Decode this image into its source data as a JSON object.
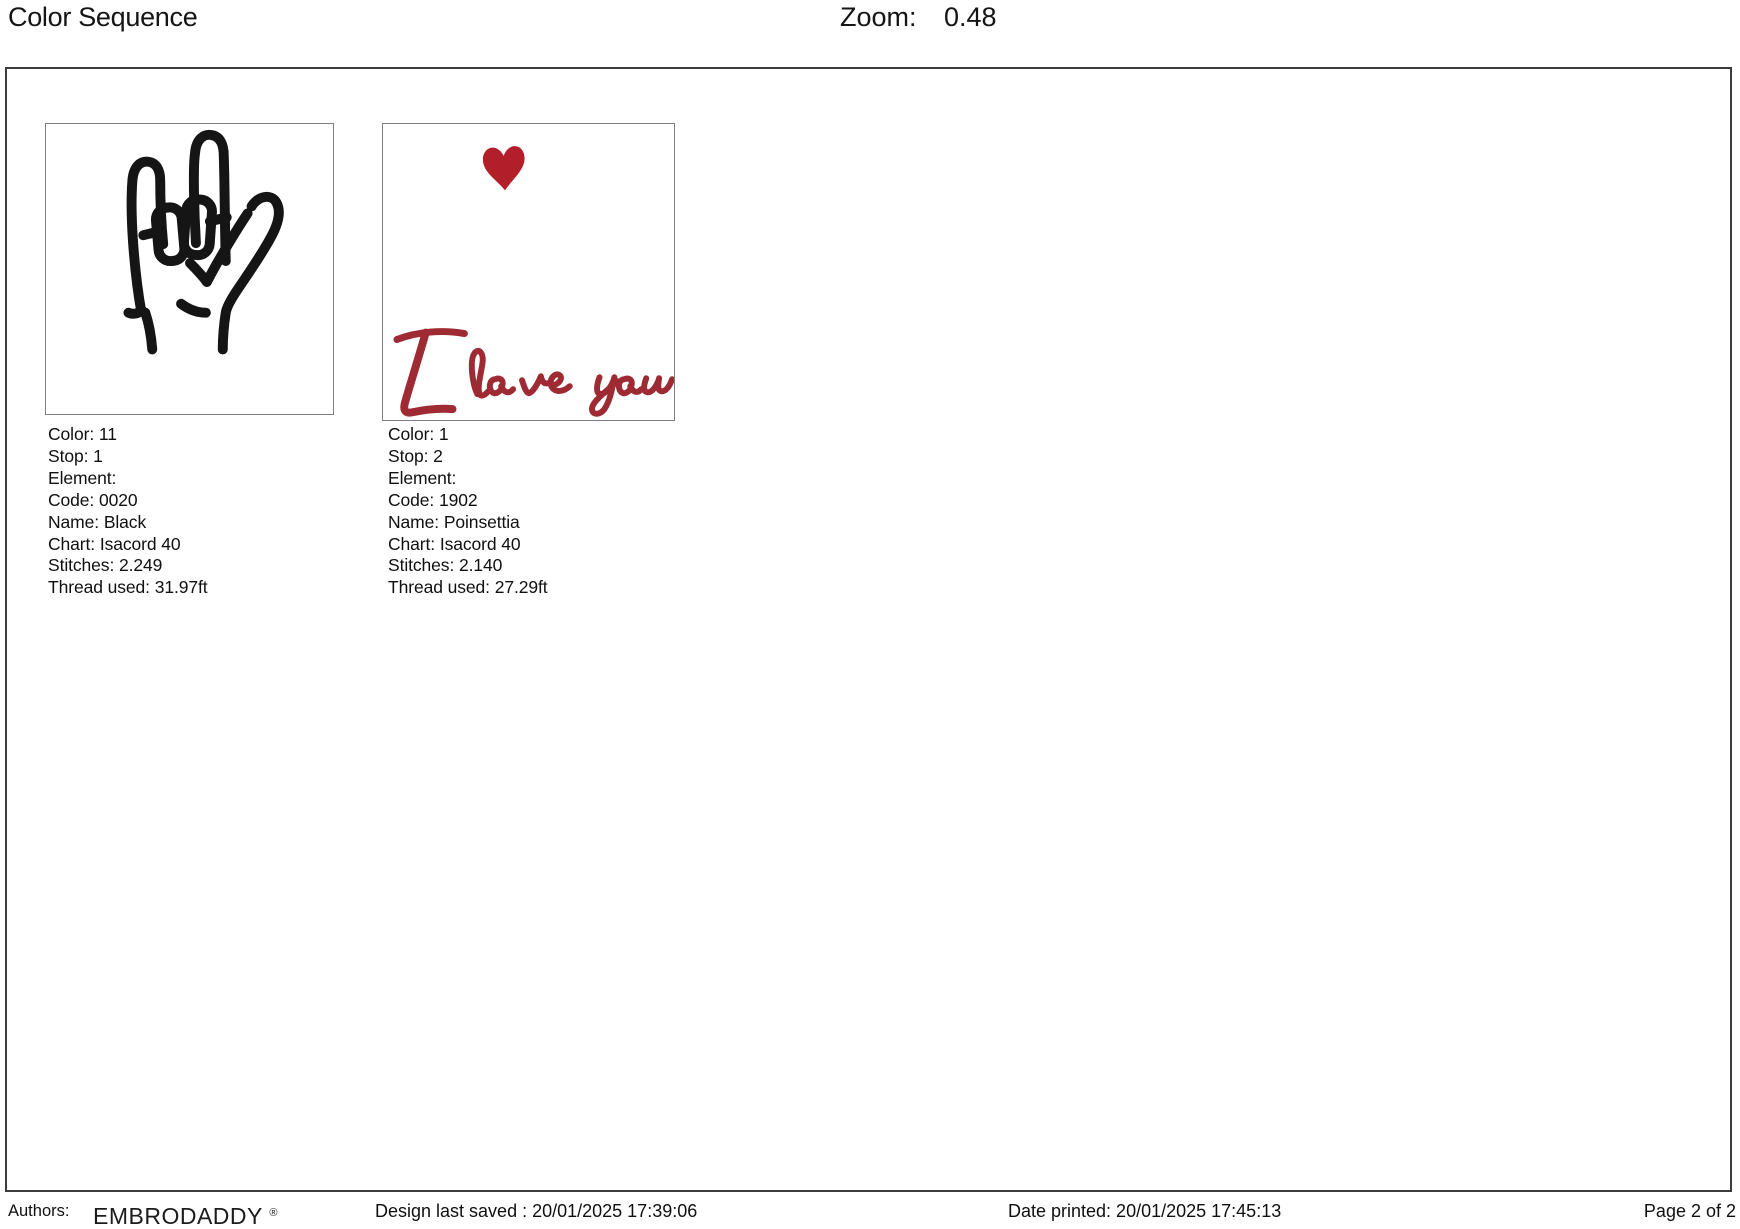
{
  "header": {
    "title": "Color Sequence",
    "zoom_label": "Zoom:",
    "zoom_value": "0.48"
  },
  "panels": [
    {
      "thumbnail": "asl-i-love-you-hand-sign",
      "fields": [
        {
          "label": "Color:",
          "value": "11"
        },
        {
          "label": "Stop:",
          "value": "1"
        },
        {
          "label": "Element:",
          "value": ""
        },
        {
          "label": "Code:",
          "value": "0020"
        },
        {
          "label": "Name:",
          "value": "Black"
        },
        {
          "label": "Chart:",
          "value": "Isacord 40"
        },
        {
          "label": "Stitches:",
          "value": "2.249"
        },
        {
          "label": "Thread used:",
          "value": "31.97ft"
        }
      ]
    },
    {
      "thumbnail": "heart-with-i-love-you-script",
      "fields": [
        {
          "label": "Color:",
          "value": "1"
        },
        {
          "label": "Stop:",
          "value": "2"
        },
        {
          "label": "Element:",
          "value": ""
        },
        {
          "label": "Code:",
          "value": "1902"
        },
        {
          "label": "Name:",
          "value": "Poinsettia"
        },
        {
          "label": "Chart:",
          "value": "Isacord 40"
        },
        {
          "label": "Stitches:",
          "value": "2.140"
        },
        {
          "label": "Thread used:",
          "value": "27.29ft"
        }
      ]
    }
  ],
  "footer": {
    "authors_label": "Authors:",
    "brand": "EMBRODADDY",
    "registered_mark": "®",
    "design_last_saved": "Design last saved : 20/01/2025 17:39:06",
    "date_printed": "Date printed: 20/01/2025 17:45:13",
    "page": "Page 2 of 2"
  },
  "colors": {
    "hand_black": "#151515",
    "heart_red": "#b21f2a",
    "script_red": "#9e2a33"
  }
}
